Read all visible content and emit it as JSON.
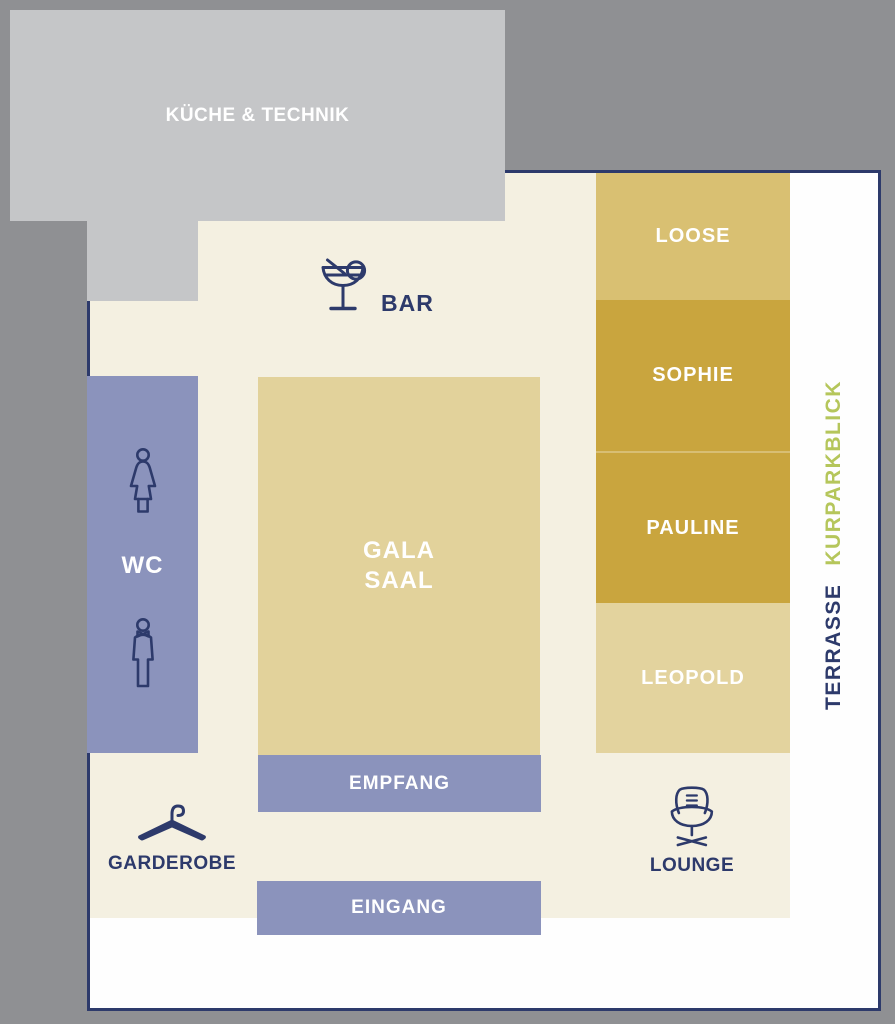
{
  "floorplan": {
    "rooms": {
      "kueche": "KÜCHE & TECHNIK",
      "bar": "BAR",
      "wc": "WC",
      "gala_line1": "GALA",
      "gala_line2": "SAAL",
      "loose": "LOOSE",
      "sophie": "SOPHIE",
      "pauline": "PAULINE",
      "leopold": "LEOPOLD",
      "empfang": "EMPFANG",
      "eingang": "EINGANG",
      "garderobe": "GARDEROBE",
      "lounge": "LOUNGE",
      "terrasse": "TERRASSE",
      "kurparkblick": "KURPARKBLICK"
    },
    "icons": {
      "bar": "cocktail-icon",
      "wc_female": "woman-icon",
      "wc_male": "man-icon",
      "garderobe": "coat-hanger-icon",
      "lounge": "lounge-chair-icon"
    },
    "colors": {
      "background_gray": "#8f9093",
      "kitchen_gray": "#c5c6c8",
      "floor_cream": "#f4f0e1",
      "room_purple": "#8b93bc",
      "gala_tan": "#e2d29b",
      "loose_gold": "#d9c072",
      "sophie_pauline_gold": "#c9a53e",
      "leopold_tan": "#e3d39e",
      "accent_navy": "#2d3a6b",
      "kurpark_olive": "#b5c65b",
      "map_white": "#fefefe"
    }
  }
}
